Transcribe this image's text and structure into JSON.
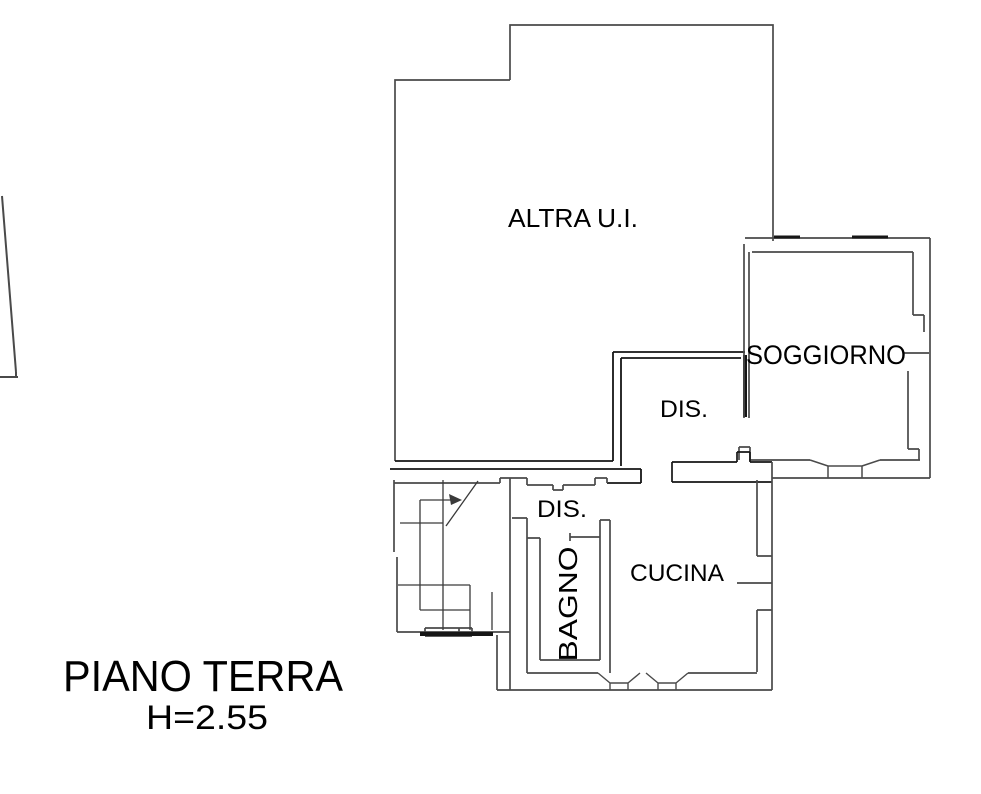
{
  "plan": {
    "labels": {
      "altra_ui": "ALTRA U.I.",
      "soggiorno": "SOGGIORNO",
      "dis_upper": "DIS.",
      "dis_lower": "DIS.",
      "cucina": "CUCINA",
      "bagno": "BAGNO"
    },
    "title": {
      "floor": "PIANO TERRA",
      "height": "H=2.55"
    },
    "colors": {
      "wall": "#4a4a4a",
      "wall_dark": "#161616",
      "stair_line": "#3a3a3a",
      "text": "#000000",
      "background": "#ffffff"
    }
  }
}
